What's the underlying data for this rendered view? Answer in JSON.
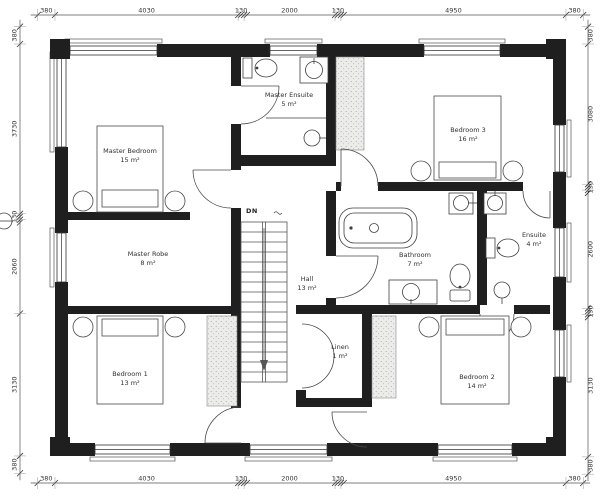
{
  "drawing": {
    "type_label": "First floor plan"
  },
  "rooms": [
    {
      "id": "master-bedroom",
      "name": "Master Bedroom",
      "area": "15 m²"
    },
    {
      "id": "master-ensuite",
      "name": "Master Ensuite",
      "area": "5 m²"
    },
    {
      "id": "bedroom-3",
      "name": "Bedroom 3",
      "area": "16 m²"
    },
    {
      "id": "master-robe",
      "name": "Master Robe",
      "area": "8 m²"
    },
    {
      "id": "hall",
      "name": "Hall",
      "area": "13 m²"
    },
    {
      "id": "bathroom",
      "name": "Bathroom",
      "area": "7 m²"
    },
    {
      "id": "ensuite",
      "name": "Ensuite",
      "area": "4 m²"
    },
    {
      "id": "linen",
      "name": "Linen",
      "area": "1 m²"
    },
    {
      "id": "bedroom-1",
      "name": "Bedroom 1",
      "area": "13 m²"
    },
    {
      "id": "bedroom-2",
      "name": "Bedroom 2",
      "area": "14 m²"
    }
  ],
  "stairs": {
    "label": "DN"
  },
  "dimensions": {
    "top": [
      "380",
      "4030",
      "130",
      "2000",
      "130",
      "4950",
      "380"
    ],
    "bottom": [
      "380",
      "4030",
      "130",
      "2000",
      "130",
      "4950",
      "380"
    ],
    "left": [
      "380",
      "3730",
      "130",
      "2060",
      "3130",
      "380"
    ],
    "right": [
      "380",
      "3080",
      "130",
      "2600",
      "130",
      "3130",
      "380"
    ]
  },
  "colors": {
    "wall": "#1f1f1f",
    "fixture_line": "#3f3f3f",
    "dim_line": "#555555",
    "paper": "#ffffff"
  }
}
